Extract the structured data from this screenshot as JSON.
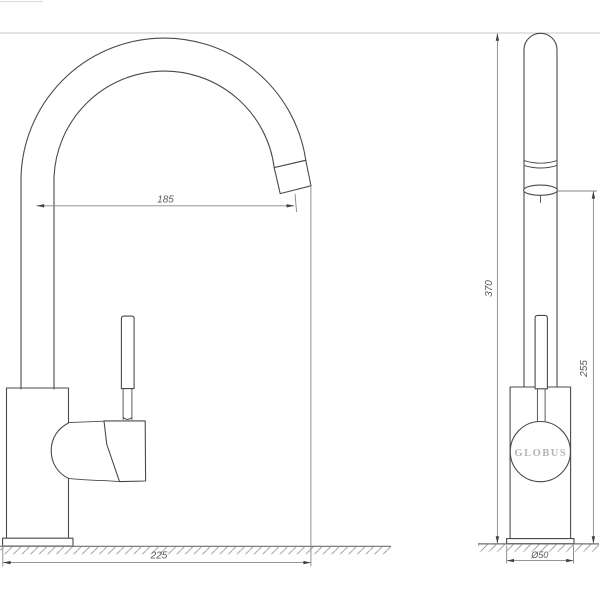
{
  "brand": {
    "logo_text": "GLOBUS"
  },
  "dimensions": {
    "spout_reach": "185",
    "overall_reach": "225",
    "overall_height": "370",
    "outlet_height": "255",
    "base_diameter": "Ø50"
  },
  "colors": {
    "object_line": "#4a4a4a",
    "dimension_line": "#868686",
    "extension_line": "#c8c8c8",
    "hatch_line": "#949494",
    "brand_text": "#b4b4b4",
    "background": "#ffffff"
  }
}
